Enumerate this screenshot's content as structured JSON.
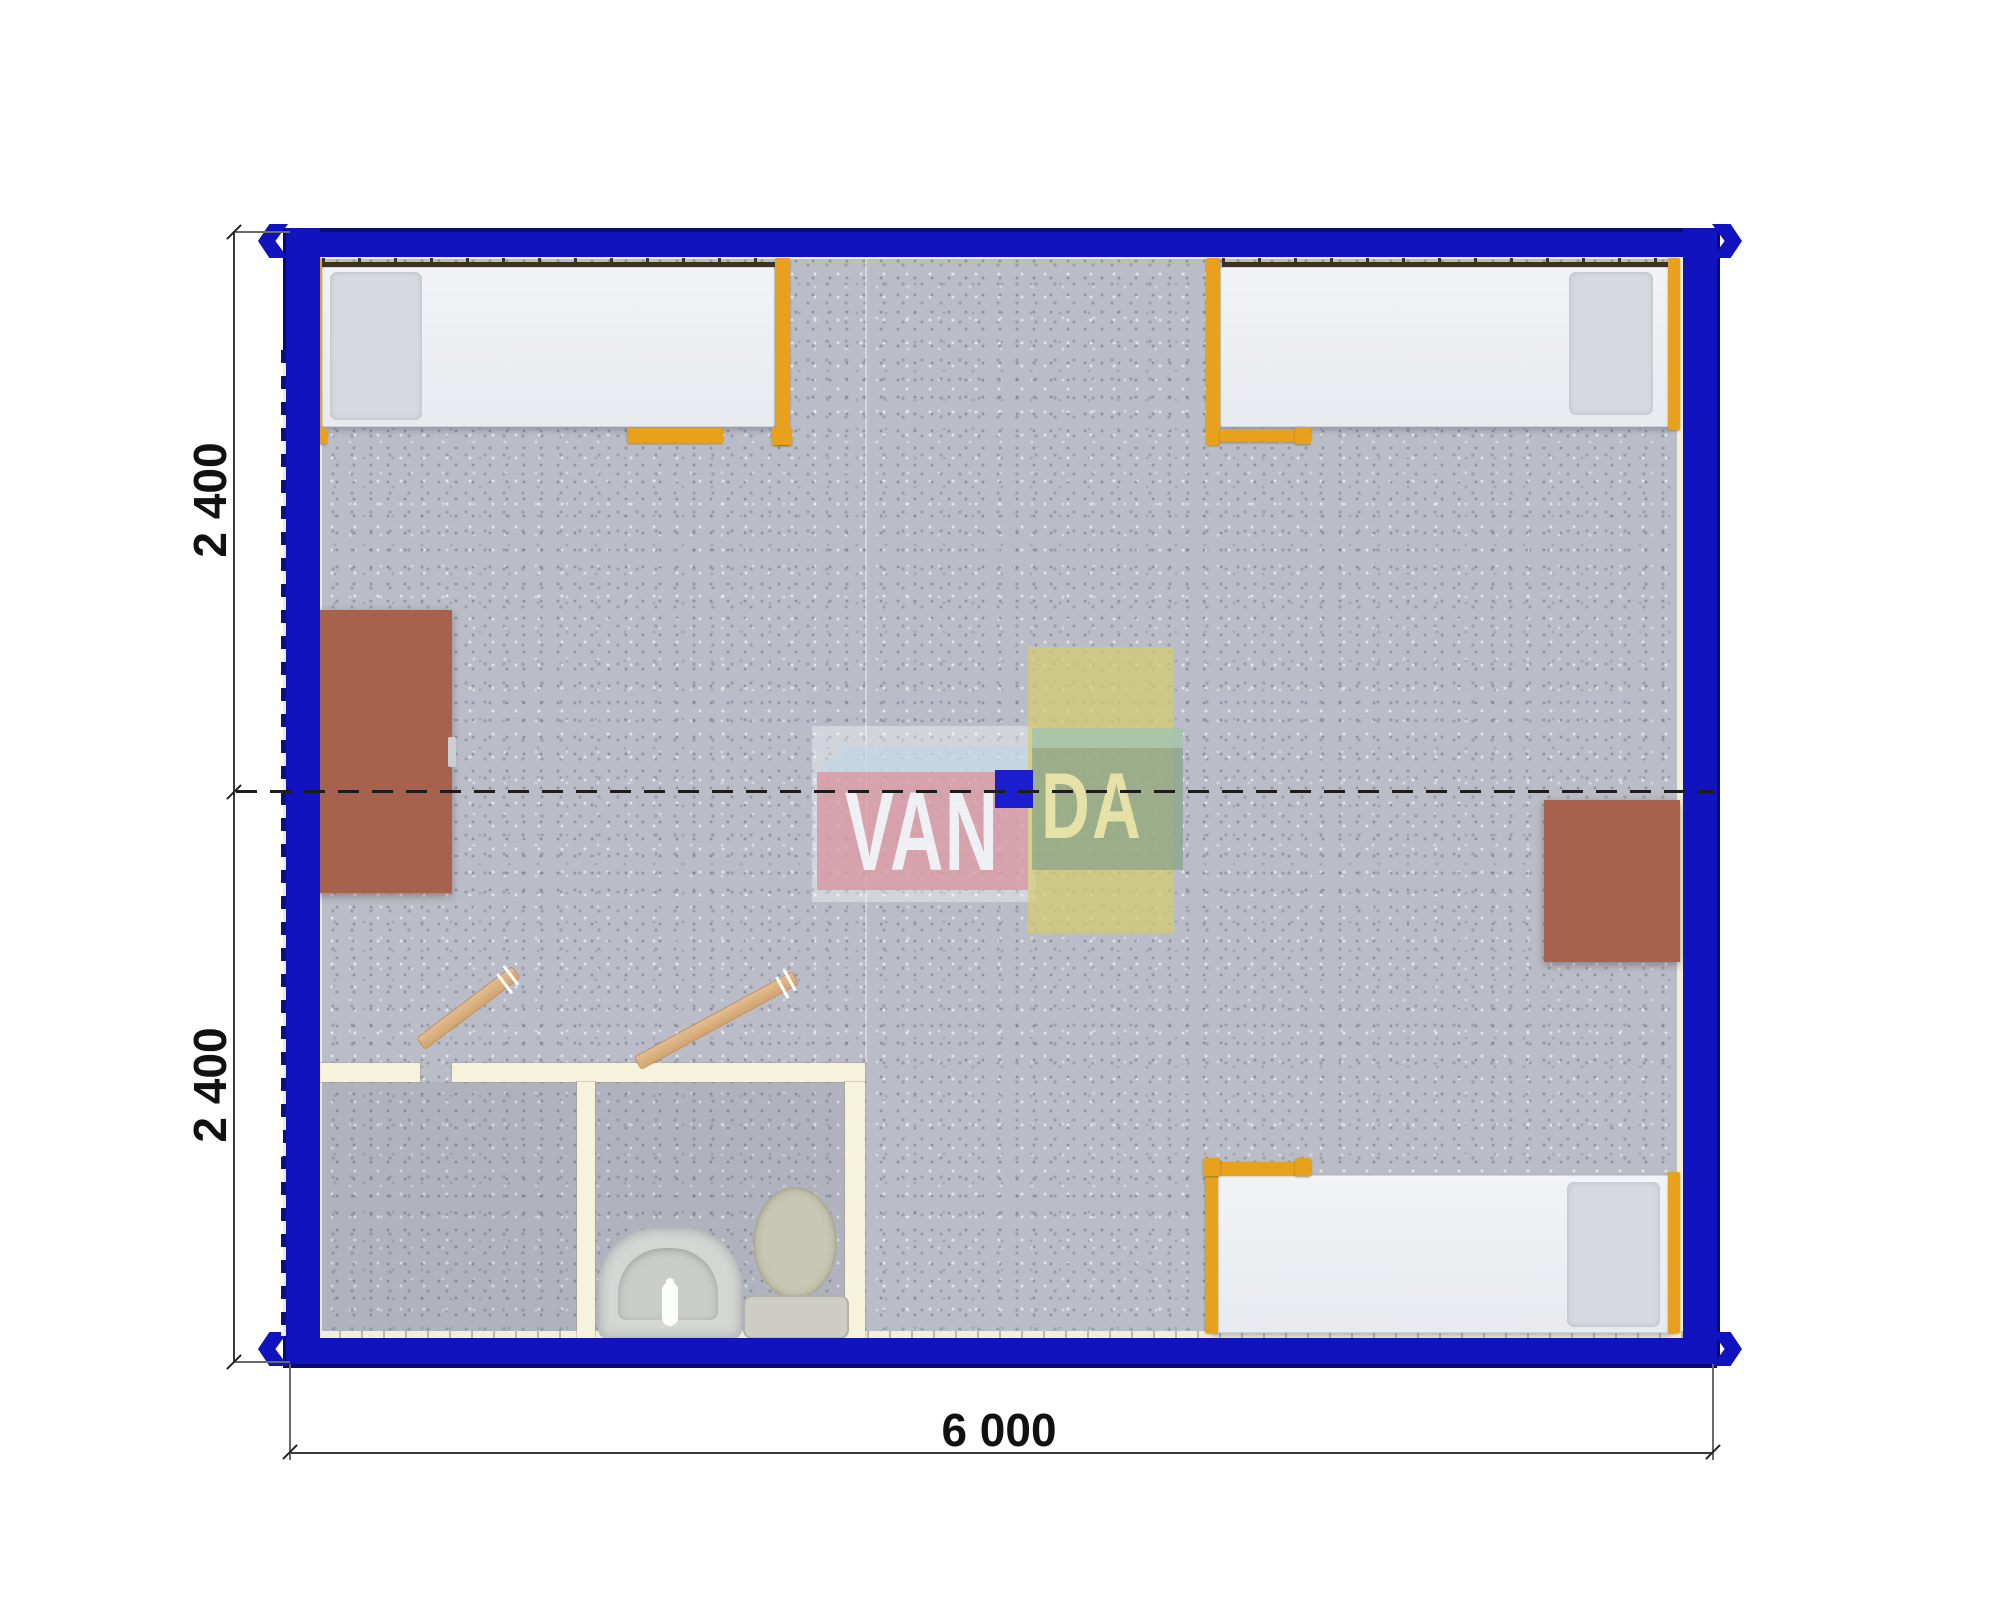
{
  "drawing": {
    "type": "container-cabin-floor-plan",
    "dimensions": {
      "left_top": "2 400",
      "left_bottom": "2 400",
      "bottom": "6 000"
    },
    "watermark": {
      "van": "VAN",
      "da": "DA"
    },
    "colors": {
      "wall_blue": "#1113be",
      "wall_edge_navy": "#0a0b72",
      "bed_frame_orange": "#e8a11c",
      "floor_gray": "#babdc7",
      "desk_brown": "#a6624c",
      "bathroom_wall_cream": "#f6f2dc",
      "door_wood": "#d8ab78",
      "logo_pink": "#d8909b",
      "logo_green": "#87a58a",
      "logo_yellow": "#d5cc72",
      "logo_blue_square": "#1a1ecc"
    }
  }
}
